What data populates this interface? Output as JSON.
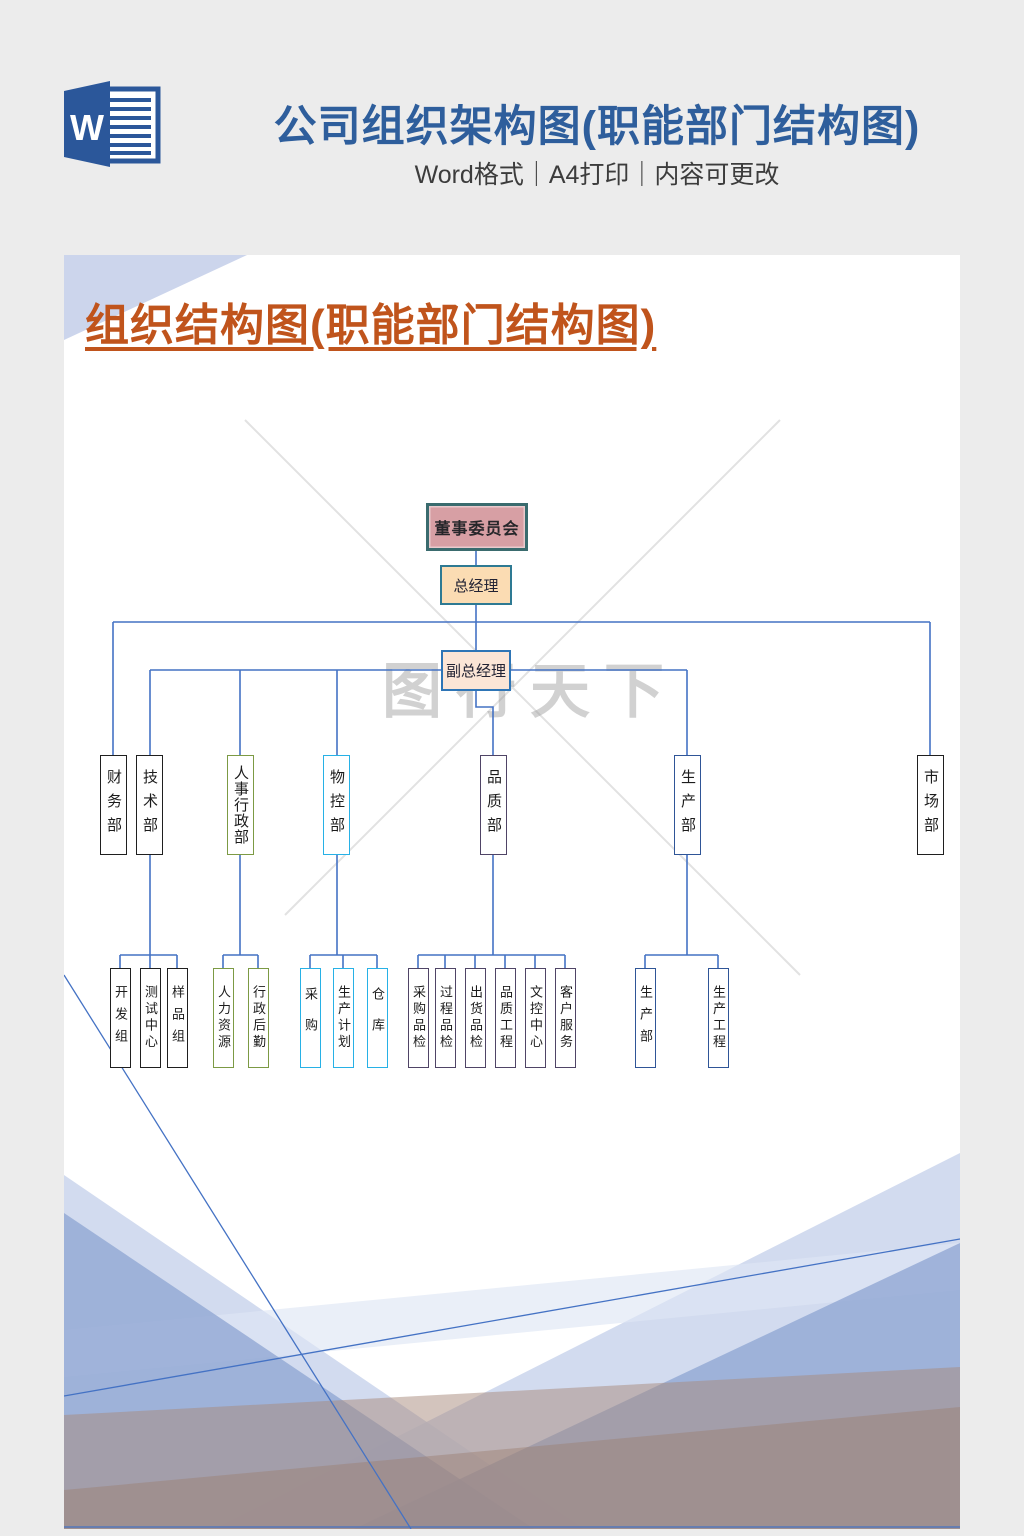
{
  "header": {
    "word_icon_letter": "W",
    "title": "公司组织架构图(职能部门结构图)",
    "subtitle": "Word格式｜A4打印｜内容可更改"
  },
  "document": {
    "heading": "组织结构图(职能部门结构图)",
    "watermark": "图行天下"
  },
  "org_chart": {
    "board": "董事委员会",
    "general_manager": "总经理",
    "deputy_gm": "副总经理",
    "departments": [
      {
        "label": "财务部",
        "children": []
      },
      {
        "label": "技术部",
        "children": [
          "开发组",
          "测试中心",
          "样品组"
        ]
      },
      {
        "label": "人事行政部",
        "children": [
          "人力资源",
          "行政后勤"
        ]
      },
      {
        "label": "物控部",
        "children": [
          "采购",
          "生产计划",
          "仓库"
        ]
      },
      {
        "label": "品质部",
        "children": [
          "采购品检",
          "过程品检",
          "出货品检",
          "品质工程",
          "文控中心",
          "客户服务"
        ]
      },
      {
        "label": "生产部",
        "children": [
          "生产部",
          "生产工程"
        ]
      },
      {
        "label": "市场部",
        "children": []
      }
    ]
  },
  "colors": {
    "header_title_blue": "#2e5e9c",
    "heading_orange": "#c0541c",
    "connector_blue": "#4472c4",
    "board_fill": "#d79fa4",
    "board_border": "#3a6b6e",
    "gm_fill": "#fbdcb3",
    "gm_border": "#2e7a93",
    "vgm_fill": "#fbe5d6",
    "vgm_border": "#2e75b6",
    "dept_black": "#1f1f1f",
    "dept_olive": "#7c9a44",
    "dept_cyan": "#27b1e6",
    "dept_purple": "#4f4466",
    "dept_navy": "#2f5597",
    "word_icon_blue": "#2b579a",
    "wave_light": "#c3cfe9",
    "wave_medium": "#91a7d3",
    "wave_taupe": "#a8897c"
  }
}
